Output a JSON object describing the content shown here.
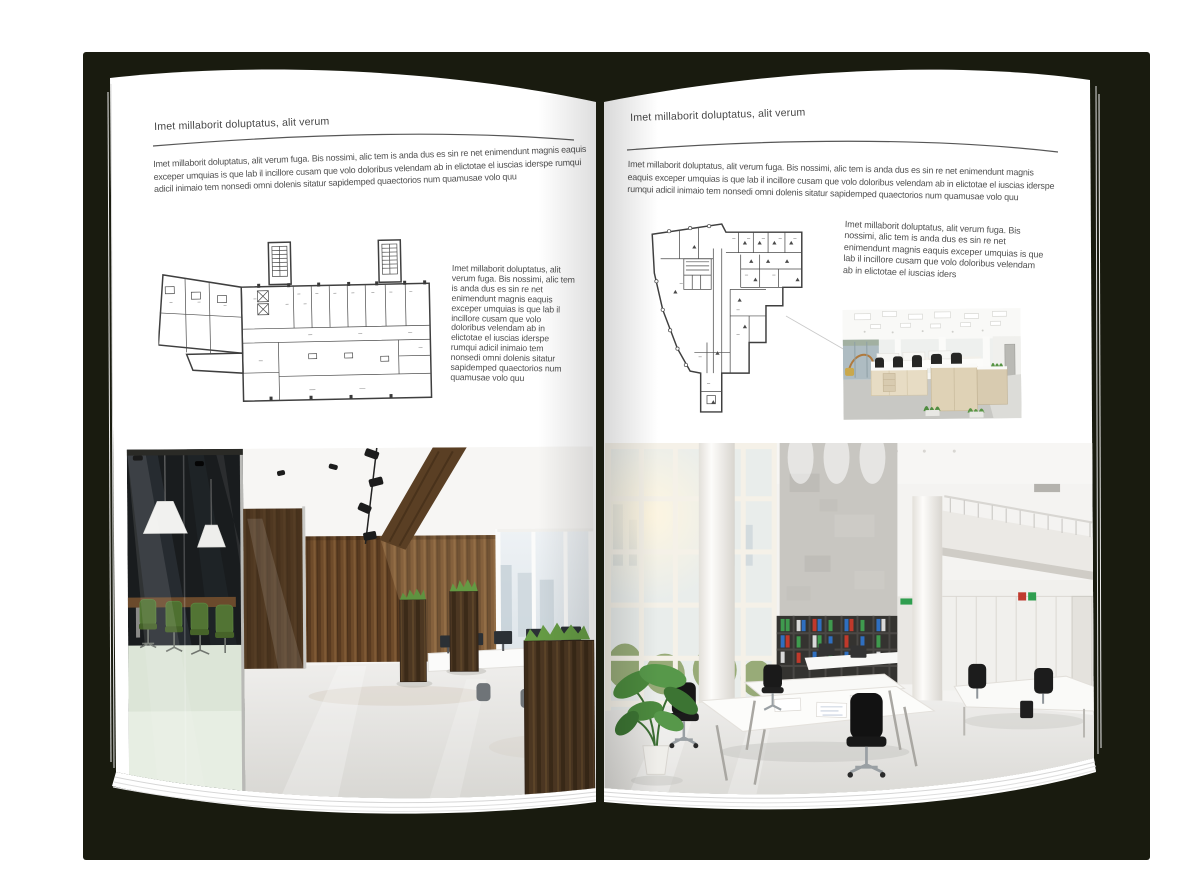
{
  "book": {
    "colors": {
      "backdrop": "#191b0f",
      "page": "#ffffff",
      "text": "#4a4a4a",
      "rule": "#555555",
      "wood_accent": "#6e4c2c",
      "plant_green": "#4f8a3e"
    },
    "left_page": {
      "header": "Imet millaborit doluptatus, alit verum",
      "intro": "Imet millaborit doluptatus, alit verum fuga. Bis nossimi, alic tem is anda dus es sin re net enimendunt magnis eaquis exceper umquias is que lab il incillore cusam que volo doloribus velendam ab in elictotae el iuscias iderspe rumqui adicil inimaio tem nonsedi omni dolenis sitatur sapidemped quaectorios num quamusae volo quu",
      "caption": "Imet millaborit doluptatus, alit verum fuga. Bis nossimi, alic tem is anda dus es sin re net enimendunt magnis eaquis exceper umquias is que lab il incillore cusam que volo doloribus velendam ab in elictotae el iuscias iderspe rumqui adicil inimaio tem nonsedi omni dolenis sitatur sapidemped quaectorios num quamusae volo quu"
    },
    "right_page": {
      "header": "Imet millaborit doluptatus, alit verum",
      "intro": "Imet millaborit doluptatus, alit verum fuga. Bis nossimi, alic tem is anda dus es sin re net enimendunt magnis eaquis exceper umquias is que lab il incillore cusam que volo doloribus velendam ab in elictotae el iuscias iderspe rumqui adicil inimaio tem nonsedi omni dolenis sitatur sapidemped quaectorios num quamusae volo quu",
      "caption": "Imet millaborit doluptatus, alit verum fuga. Bis nossimi, alic tem is anda dus es sin re net enimendunt magnis eaquis exceper umquias is que lab il incillore cusam que volo doloribus velendam ab in elictotae el iuscias iders"
    }
  }
}
